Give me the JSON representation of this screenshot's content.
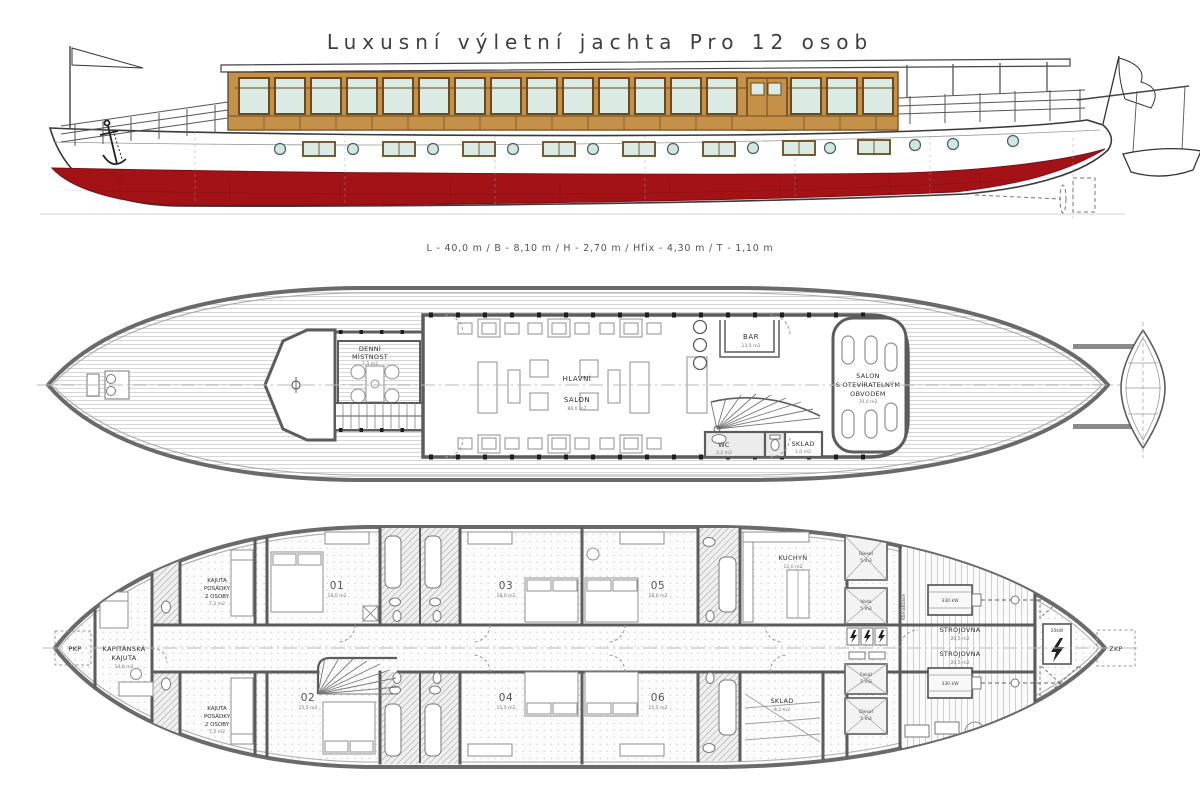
{
  "title": "Luxusní výletní jachta Pro 12 osob",
  "dimensions": "L - 40,0 m / B - 8,10 m / H - 2,70 m / Hfix - 4,30 m / T - 1,10 m",
  "colors": {
    "hull_red": "#a31217",
    "wood": "#c59149",
    "glass": "#d9ebe3",
    "wall_gray": "#5c5c5c"
  },
  "main_deck": {
    "denni_mistnost": {
      "line1": "DENNÍ",
      "line2": "MÍSTNOST",
      "area": "7,3 m2"
    },
    "hlavni_salon": {
      "line1": "HLAVNÍ",
      "line2": "SALON",
      "area": "86,0 m2"
    },
    "bar": {
      "name": "BAR",
      "area": "13,5 m2"
    },
    "salon_obvodem": {
      "line1": "SALON",
      "line2": "S OTEVÍRATELNÝM",
      "line3": "OBVODEM",
      "area": "70,0 m2"
    },
    "wc": {
      "name": "WC",
      "area": "3,2 m2"
    },
    "sklad": {
      "name": "SKLAD",
      "area": "1,0 m2"
    }
  },
  "lower_deck": {
    "pkp": "PKP",
    "zkp": "ZKP",
    "kapitanska_kajuta": {
      "line1": "KAPITÁNSKÁ",
      "line2": "KAJUTA",
      "area": "14,6 m2"
    },
    "kajuta_posadky_top": {
      "line1": "KAJUTA",
      "line2": "POSÁDKY",
      "line3": "2 OSOBY",
      "area": "7,2 m2"
    },
    "kajuta_posadky_bottom": {
      "line1": "KAJUTA",
      "line2": "POSÁDKY",
      "line3": "2 OSOBY",
      "area": "7,2 m2"
    },
    "cabins": [
      {
        "num": "01",
        "area": "18,0 m2"
      },
      {
        "num": "02",
        "area": "15,5 m2"
      },
      {
        "num": "03",
        "area": "18,0 m2"
      },
      {
        "num": "04",
        "area": "15,5 m2"
      },
      {
        "num": "05",
        "area": "18,0 m2"
      },
      {
        "num": "06",
        "area": "15,5 m2"
      }
    ],
    "kuchyn": {
      "name": "KUCHYŇ",
      "area": "12,0 m2"
    },
    "sklad": {
      "name": "SKLAD",
      "area": "9,2 m2"
    },
    "strojovna_top": {
      "name": "STROJOVNA",
      "area": "20,5 m2"
    },
    "strojovna_bottom": {
      "name": "STROJOVNA",
      "area": "20,5 m2"
    },
    "engine_top": "330 kW",
    "engine_bottom": "330 kW",
    "generator": "20kW",
    "klimatizace": "Klimatizace",
    "tanks": [
      {
        "name": "Diesel",
        "vol": "5 m3"
      },
      {
        "name": "Voda",
        "vol": "5 m3"
      },
      {
        "name": "Fekál",
        "vol": "5 m3"
      },
      {
        "name": "Diesel",
        "vol": "5 m3"
      }
    ]
  }
}
